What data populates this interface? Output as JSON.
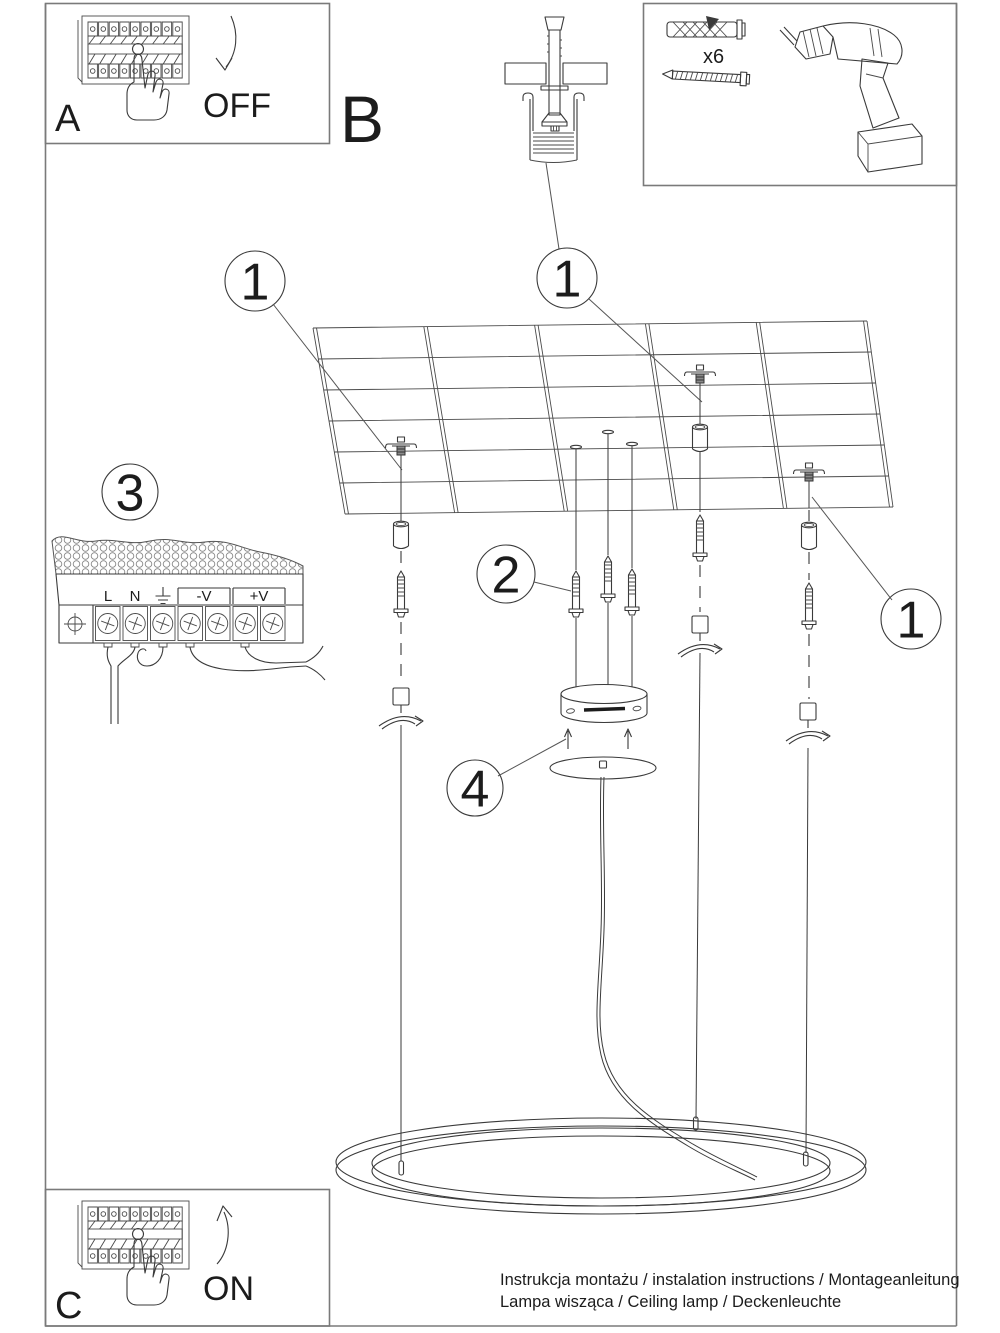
{
  "page": {
    "background": "#ffffff",
    "frame_color": "#7a7a7a",
    "ink_color": "#3a3a3a",
    "text_color": "#1c1c1c"
  },
  "steps": {
    "a": {
      "label": "A",
      "caption": "OFF"
    },
    "b": {
      "label": "B"
    },
    "c": {
      "label": "C",
      "caption": "ON"
    }
  },
  "parts_box": {
    "anchor_quantity": "x6"
  },
  "callouts": {
    "ceiling_plug_top": "1",
    "ceiling_plug_left": "1",
    "ceiling_plug_right": "1",
    "mounting_screws": "2",
    "power_supply": "3",
    "canopy": "4"
  },
  "power_supply_terminals": {
    "live": "L",
    "neutral": "N",
    "earth_icon": "earth-ground-symbol",
    "negative": "-V",
    "positive": "+V"
  },
  "footer": {
    "line1": "Instrukcja montażu / instalation instructions / Montageanleitung",
    "line2": "Lampa wisząca / Ceiling lamp / Deckenleuchte"
  }
}
